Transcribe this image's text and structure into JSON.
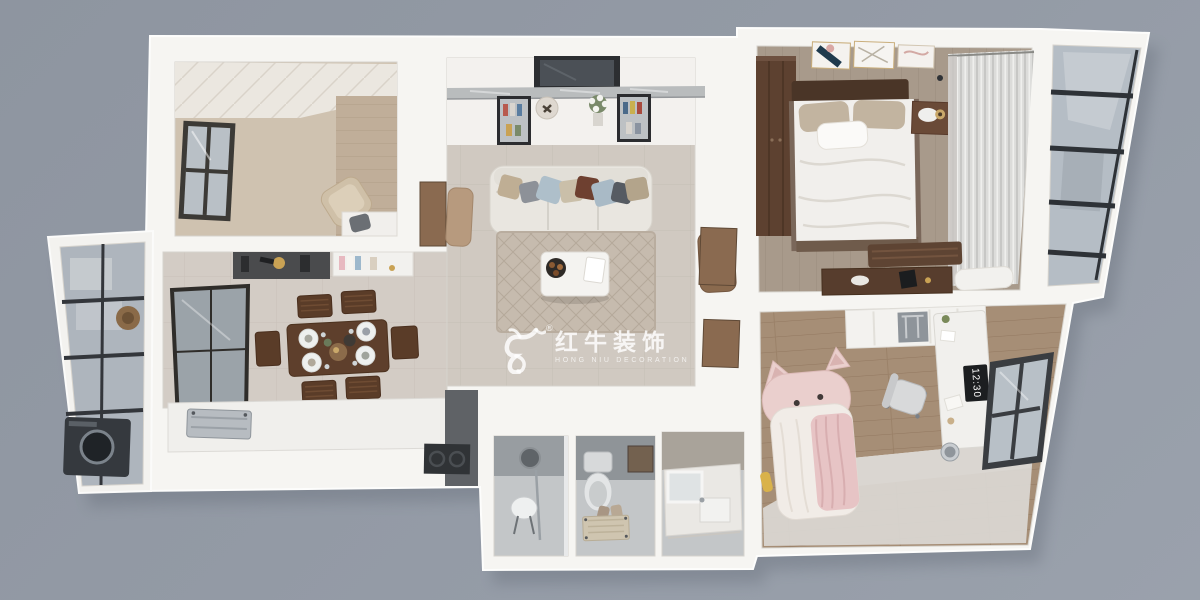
{
  "scene": {
    "type": "3d-apartment-floorplan-render",
    "background_color": "#939aa5",
    "wall_color": "#f6f5f2",
    "shadow_color": "#565e6b"
  },
  "watermark": {
    "icon": "bull-logo",
    "registered_mark": "®",
    "title_cn": "红牛装饰",
    "subtitle_en": "HONG NIU DECORATION",
    "text_color": "#ffffff"
  },
  "palette": {
    "living_floor": "#d0c9c1",
    "dining_floor": "#d3ccc5",
    "study_floor": "#cfc2b0",
    "master_floor": "#a89a8b",
    "kids_floor": "#a68e76",
    "bathroom_floor": "#c3c6c8",
    "balcony_glass": "#b5bdc5",
    "dark_wood": "#5d4130",
    "accent_pink": "#e9cdcb",
    "rug": "#c6bbae"
  },
  "rooms": [
    {
      "name": "study",
      "floor_color": "#cfc2b0",
      "furniture": [
        "window",
        "lounge-chair",
        "desk",
        "desk-chair",
        "wood-accent-wall"
      ]
    },
    {
      "name": "living-room",
      "floor_color": "#d0c9c1",
      "furniture": [
        "tv",
        "marble-media-console",
        "display-cabinet-left",
        "display-cabinet-right",
        "flower-vase",
        "wall-plate-decor",
        "sofa",
        "throw-pillows",
        "area-rug",
        "coffee-table",
        "snack-tray",
        "armchair-left",
        "armchair-right"
      ]
    },
    {
      "name": "master-bedroom",
      "floor_color": "#a89a8b",
      "furniture": [
        "wardrobe",
        "double-bed",
        "pillows",
        "nightstand",
        "table-lamp",
        "wall-art-frames",
        "sheer-curtains",
        "bed-end-bench",
        "dresser",
        "ceiling-spotlights"
      ]
    },
    {
      "name": "balcony-right",
      "floor_color": "#b5bdc5",
      "furniture": [
        "glass-curtain-wall"
      ]
    },
    {
      "name": "laundry-balcony-left",
      "floor_color": "#aeb5bd",
      "furniture": [
        "glass-windows",
        "washing-machine",
        "storage-shelf",
        "straw-hat"
      ]
    },
    {
      "name": "dining-room",
      "floor_color": "#d3ccc5",
      "furniture": [
        "dining-table",
        "dining-chairs",
        "place-settings",
        "dark-sideboard",
        "white-bookshelf",
        "window-partition"
      ]
    },
    {
      "name": "kitchen",
      "floor_color": "#5f6266",
      "furniture": [
        "counter",
        "range-hood",
        "cooktop"
      ]
    },
    {
      "name": "bathroom",
      "floor_color": "#c3c6c8",
      "furniture": [
        "round-mirror",
        "shower-stool",
        "toilet",
        "bath-mat",
        "vanity-counter",
        "sink",
        "vanity-mirror"
      ]
    },
    {
      "name": "kids-room",
      "floor_color": "#a68e76",
      "clock_time": "12:30",
      "furniture": [
        "cat-shaped-bed",
        "pink-blanket",
        "wardrobe",
        "study-desk",
        "office-chair",
        "desk-clock",
        "window",
        "trash-bin",
        "floor-platform"
      ]
    }
  ]
}
